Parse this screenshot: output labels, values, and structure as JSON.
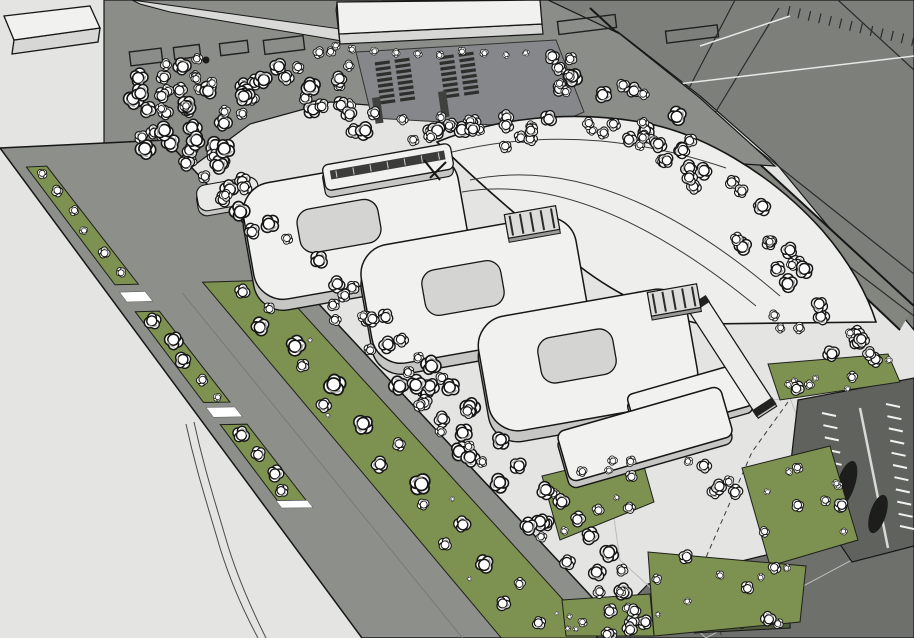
{
  "meta": {
    "app": "3d-architectural-site-model",
    "description": "Aerial oblique rendering of a campus: three rounded courtyard buildings, a large fan-shaped hall, tree-lined boulevard, parking lots and groves of white model trees",
    "canvas": {
      "width": 914,
      "height": 638
    }
  },
  "palette": {
    "field": "#e4e4e2",
    "zone": "#7d7f7a",
    "band": "#8b8d88",
    "road": "#8d8f8a",
    "wedge": "#d9d9d7",
    "green": "#7d9150",
    "hedge": "#4e5b3c",
    "parking_dark": "#60625e",
    "bottom_road": "#6e706c",
    "stall_dark": "#2e2e2c",
    "building_top": "#f1f1ef",
    "building_side": "#d7d7d5",
    "building_base": "#c6c6c4",
    "courtyard": "#d4d4d2",
    "slab_end": "#3a3a38",
    "outline": "#161616",
    "white": "#ffffff",
    "line_dark": "#2b2b2b",
    "line_white": "#e8e8e6",
    "shadow": "#a8a8a6",
    "connector": "#dcdcda",
    "dash": "#3a3a3a"
  },
  "scene": {
    "zone_poly": [
      [
        545,
        0
      ],
      [
        914,
        0
      ],
      [
        914,
        330
      ],
      [
        775,
        162
      ],
      [
        700,
        96
      ],
      [
        618,
        32
      ]
    ],
    "boundary_band": [
      [
        590,
        8
      ],
      [
        914,
        306
      ],
      [
        900,
        330
      ],
      [
        574,
        22
      ]
    ],
    "boundary_lines": [
      [
        590,
        8,
        914,
        306
      ],
      [
        574,
        22,
        900,
        330
      ]
    ],
    "zone_dark_lines": [
      [
        735,
        0,
        686,
        94
      ],
      [
        779,
        8,
        712,
        118
      ],
      [
        690,
        96,
        914,
        274
      ],
      [
        660,
        122,
        914,
        316
      ],
      [
        838,
        0,
        914,
        70
      ]
    ],
    "zone_white_lines": [
      [
        644,
        88,
        914,
        56
      ],
      [
        700,
        46,
        790,
        16
      ]
    ],
    "zone_ticks": {
      "x1": 790,
      "y1": 6,
      "x2": 914,
      "y2": 36,
      "n": 12,
      "len": 10
    },
    "band_poly": [
      [
        104,
        0
      ],
      [
        548,
        0
      ],
      [
        620,
        34
      ],
      [
        700,
        98
      ],
      [
        775,
        166
      ],
      [
        712,
        162
      ],
      [
        546,
        128
      ],
      [
        430,
        110
      ],
      [
        330,
        102
      ],
      [
        250,
        124
      ],
      [
        188,
        170
      ],
      [
        104,
        164
      ]
    ],
    "wedge_poly": [
      [
        132,
        0
      ],
      [
        348,
        30
      ],
      [
        348,
        42
      ],
      [
        170,
        12
      ],
      [
        140,
        4
      ]
    ],
    "footprints": [
      [
        130,
        50,
        32,
        14,
        -7
      ],
      [
        174,
        46,
        26,
        12,
        -7
      ],
      [
        220,
        42,
        28,
        12,
        -7
      ],
      [
        264,
        38,
        40,
        14,
        -7
      ],
      [
        558,
        18,
        58,
        13,
        -7
      ],
      [
        666,
        28,
        52,
        12,
        -7
      ]
    ],
    "footprint_dot": [
      206,
      60,
      3.5
    ],
    "boulevard": {
      "L0": [
        0,
        148
      ],
      "L1": [
        362,
        638
      ],
      "R0": [
        166,
        140
      ],
      "R1": [
        630,
        638
      ],
      "green_a": {
        "f0": 0.07,
        "f1": 0.19,
        "segs": [
          [
            0.04,
            0.28
          ],
          [
            0.335,
            0.52
          ],
          [
            0.565,
            0.72
          ]
        ]
      },
      "green_b": {
        "f0": 0.52,
        "f1": 0.88,
        "segs": [
          [
            0.28,
            1.0
          ]
        ]
      },
      "bars": [
        [
          0.295,
          0.315
        ],
        [
          0.53,
          0.55
        ],
        [
          0.72,
          0.735
        ]
      ],
      "lane_line": {
        "f": 0.375,
        "s0": 0.3,
        "s1": 1.0
      },
      "trees_a": [
        [
          0.055,
          0.13,
          6
        ],
        [
          0.09,
          0.14,
          7
        ],
        [
          0.13,
          0.15,
          6
        ],
        [
          0.17,
          0.12,
          5
        ],
        [
          0.215,
          0.14,
          7
        ],
        [
          0.255,
          0.15,
          6
        ],
        [
          0.355,
          0.12,
          10
        ],
        [
          0.395,
          0.15,
          11
        ],
        [
          0.435,
          0.12,
          10
        ],
        [
          0.475,
          0.14,
          7
        ],
        [
          0.51,
          0.15,
          5
        ],
        [
          0.585,
          0.13,
          10
        ],
        [
          0.625,
          0.14,
          9
        ],
        [
          0.665,
          0.15,
          10
        ],
        [
          0.7,
          0.12,
          8
        ]
      ],
      "trees_b": [
        [
          0.3,
          0.68,
          9
        ],
        [
          0.335,
          0.74,
          7
        ],
        [
          0.37,
          0.62,
          11
        ],
        [
          0.41,
          0.71,
          12
        ],
        [
          0.45,
          0.66,
          8
        ],
        [
          0.49,
          0.73,
          13
        ],
        [
          0.53,
          0.6,
          9
        ],
        [
          0.57,
          0.7,
          12
        ],
        [
          0.61,
          0.78,
          8
        ],
        [
          0.65,
          0.62,
          10
        ],
        [
          0.69,
          0.72,
          13
        ],
        [
          0.73,
          0.66,
          7
        ],
        [
          0.77,
          0.75,
          10
        ],
        [
          0.81,
          0.61,
          8
        ],
        [
          0.85,
          0.7,
          11
        ],
        [
          0.89,
          0.77,
          7
        ],
        [
          0.93,
          0.64,
          9
        ],
        [
          0.97,
          0.71,
          8
        ],
        [
          0.4,
          0.8,
          3
        ],
        [
          0.55,
          0.58,
          3
        ],
        [
          0.72,
          0.8,
          3
        ],
        [
          0.88,
          0.59,
          3
        ],
        [
          0.95,
          0.81,
          2.5
        ]
      ]
    },
    "path_lines": [
      "M 186 424 C 196 470 206 500 220 548 C 230 580 244 612 258 638",
      "M 194 422 C 204 468 214 498 228 546 C 238 578 252 610 266 638"
    ],
    "parking_top": {
      "poly": [
        [
          356,
          52
        ],
        [
          556,
          40
        ],
        [
          584,
          112
        ],
        [
          546,
          128
        ],
        [
          372,
          118
        ]
      ],
      "groups": [
        {
          "x": 392,
          "y": 60,
          "rot": -8,
          "rows": 8,
          "bw": 15,
          "bh": 3.2,
          "cgap": 5,
          "rpitch": 5.6
        },
        {
          "x": 456,
          "y": 54,
          "rot": -8,
          "rows": 8,
          "bw": 15,
          "bh": 3.2,
          "cgap": 5,
          "rpitch": 5.6
        }
      ],
      "lanes": [
        [
          372,
          98,
          8,
          26,
          -8
        ],
        [
          438,
          92,
          8,
          26,
          -8
        ]
      ]
    },
    "comb": {
      "x1": 548,
      "y1": 124,
      "x2": 714,
      "y2": 158,
      "n": 11,
      "len": 8
    },
    "bottom_road_poly": [
      [
        596,
        638
      ],
      [
        648,
        584
      ],
      [
        762,
        556
      ],
      [
        914,
        520
      ],
      [
        914,
        638
      ]
    ],
    "plaza_outline": [
      [
        600,
        420
      ],
      [
        790,
        398
      ],
      [
        852,
        560
      ],
      [
        706,
        638
      ],
      [
        620,
        560
      ]
    ],
    "hedge": {
      "cx": 742,
      "cy": 625,
      "w": 96,
      "h": 11,
      "rot": -3,
      "dots": [
        [
          716,
          624
        ],
        [
          742,
          626
        ],
        [
          768,
          623
        ]
      ]
    },
    "parking_se": {
      "poly": [
        [
          798,
          400
        ],
        [
          914,
          378
        ],
        [
          914,
          546
        ],
        [
          852,
          562
        ],
        [
          790,
          470
        ]
      ],
      "ticks": [
        {
          "x1": 836,
          "y1": 416,
          "x2": 850,
          "y2": 538,
          "n": 10,
          "nx": -14,
          "ny": -3
        },
        {
          "x1": 886,
          "y1": 404,
          "x2": 900,
          "y2": 526,
          "n": 10,
          "nx": 14,
          "ny": 3
        }
      ],
      "aisle": [
        860,
        408,
        888,
        548
      ],
      "blobs": [
        [
          846,
          484,
          9,
          24,
          18
        ],
        [
          878,
          514,
          8,
          20,
          18
        ]
      ]
    },
    "dashed_boundary": "M 788 402 L 752 452 L 704 562 L 722 638",
    "greens": [
      {
        "name": "green-island-ne-of-parking",
        "poly": [
          [
            768,
            364
          ],
          [
            888,
            354
          ],
          [
            900,
            382
          ],
          [
            780,
            400
          ]
        ],
        "n": 8,
        "seed": 37
      },
      {
        "name": "green-island-mid",
        "poly": [
          [
            742,
            468
          ],
          [
            830,
            446
          ],
          [
            858,
            540
          ],
          [
            770,
            566
          ]
        ],
        "n": 11,
        "seed": 41
      },
      {
        "name": "green-island-south",
        "poly": [
          [
            648,
            552
          ],
          [
            806,
            566
          ],
          [
            800,
            622
          ],
          [
            654,
            636
          ]
        ],
        "n": 11,
        "seed": 43
      },
      {
        "name": "green-island-sw",
        "poly": [
          [
            542,
            476
          ],
          [
            640,
            452
          ],
          [
            654,
            502
          ],
          [
            560,
            540
          ]
        ],
        "n": 9,
        "seed": 47
      },
      {
        "name": "green-island-bottom",
        "poly": [
          [
            562,
            600
          ],
          [
            650,
            594
          ],
          [
            654,
            636
          ],
          [
            566,
            636
          ]
        ],
        "n": 7,
        "seed": 53
      }
    ],
    "tree_bands": [
      {
        "name": "north-grove-west",
        "poly": [
          [
            120,
            62
          ],
          [
            358,
            48
          ],
          [
            360,
            104
          ],
          [
            252,
            118
          ],
          [
            190,
            164
          ],
          [
            126,
            148
          ]
        ],
        "n": 55,
        "rmin": 6,
        "rmax": 12,
        "seed": 7
      },
      {
        "name": "grove-south-of-parking",
        "poly": [
          [
            332,
            100
          ],
          [
            560,
            116
          ],
          [
            566,
            148
          ],
          [
            430,
            146
          ],
          [
            336,
            130
          ]
        ],
        "n": 26,
        "rmin": 6,
        "rmax": 11,
        "seed": 11
      },
      {
        "name": "north-grove-east",
        "poly": [
          [
            554,
            46
          ],
          [
            642,
            84
          ],
          [
            702,
            132
          ],
          [
            664,
            166
          ],
          [
            574,
            126
          ],
          [
            546,
            92
          ]
        ],
        "n": 30,
        "rmin": 6,
        "rmax": 12,
        "seed": 13
      },
      {
        "name": "boulevard-verge-upper",
        "poly": [
          [
            178,
            154
          ],
          [
            424,
            416
          ],
          [
            452,
            384
          ],
          [
            206,
            122
          ]
        ],
        "n": 40,
        "rmin": 6,
        "rmax": 12,
        "seed": 17
      },
      {
        "name": "boulevard-verge-lower",
        "poly": [
          [
            424,
            416
          ],
          [
            632,
            638
          ],
          [
            660,
            606
          ],
          [
            452,
            384
          ]
        ],
        "n": 34,
        "rmin": 6,
        "rmax": 12,
        "seed": 19
      },
      {
        "name": "east-boundary-band",
        "poly": [
          [
            696,
            136
          ],
          [
            880,
            326
          ],
          [
            856,
            352
          ],
          [
            746,
            256
          ],
          [
            662,
            158
          ]
        ],
        "n": 24,
        "rmin": 6,
        "rmax": 11,
        "seed": 23
      },
      {
        "name": "east-band-lower",
        "poly": [
          [
            752,
            306
          ],
          [
            886,
            342
          ],
          [
            874,
            370
          ],
          [
            744,
            336
          ]
        ],
        "n": 8,
        "rmin": 5,
        "rmax": 10,
        "seed": 29
      },
      {
        "name": "se-courtyard-cluster",
        "poly": [
          [
            652,
            440
          ],
          [
            748,
            452
          ],
          [
            742,
            502
          ],
          [
            646,
            494
          ]
        ],
        "n": 6,
        "rmin": 5,
        "rmax": 10,
        "seed": 31
      }
    ],
    "tree_row": [
      [
        336,
        46,
        5
      ],
      [
        352,
        49,
        5
      ],
      [
        374,
        51,
        5
      ],
      [
        396,
        53,
        5
      ],
      [
        418,
        54,
        5
      ],
      [
        440,
        55,
        5
      ],
      [
        462,
        51,
        5
      ],
      [
        484,
        53,
        5
      ],
      [
        506,
        55,
        4
      ],
      [
        526,
        53,
        4
      ]
    ],
    "buildings": {
      "slab_nw": {
        "top": [
          [
            4,
            16
          ],
          [
            90,
            6
          ],
          [
            100,
            28
          ],
          [
            14,
            40
          ]
        ],
        "front": [
          [
            14,
            40
          ],
          [
            100,
            28
          ],
          [
            98,
            42
          ],
          [
            12,
            54
          ]
        ]
      },
      "slab_top": {
        "top": [
          [
            337,
            2
          ],
          [
            540,
            0
          ],
          [
            542,
            24
          ],
          [
            339,
            34
          ]
        ],
        "front": [
          [
            339,
            34
          ],
          [
            542,
            24
          ],
          [
            543,
            34
          ],
          [
            340,
            44
          ]
        ],
        "end": [
          [
            337,
            2
          ],
          [
            339,
            34
          ],
          [
            340,
            44
          ],
          [
            336,
            10
          ]
        ]
      },
      "fan": {
        "outer": "M 437 142 Q 490 195 560 250 C 600 286 648 312 700 324 L 876 322 C 868 296 850 262 822 230 C 770 172 700 132 640 122 C 570 110 495 118 437 142 Z",
        "arcs": [
          "M 470 180 Q 610 150 780 296",
          "M 462 192 Q 590 170 756 306",
          "M 452 152 Q 585 120 726 168"
        ]
      },
      "blocks": [
        {
          "name": "courtyard-building-1",
          "cx": 356,
          "cy": 227,
          "w": 218,
          "h": 118,
          "r": 30,
          "rot": -10,
          "dy": 11,
          "court": {
            "cx": 339,
            "cy": 226,
            "w": 82,
            "h": 44,
            "r": 14
          }
        },
        {
          "name": "courtyard-building-2",
          "cx": 474,
          "cy": 290,
          "w": 218,
          "h": 120,
          "r": 30,
          "rot": -10,
          "dy": 11,
          "court": {
            "cx": 463,
            "cy": 288,
            "w": 80,
            "h": 46,
            "r": 14
          }
        },
        {
          "name": "courtyard-building-3",
          "cx": 588,
          "cy": 360,
          "w": 212,
          "h": 116,
          "r": 30,
          "rot": -10,
          "dy": 11,
          "court": {
            "cx": 577,
            "cy": 356,
            "w": 76,
            "h": 46,
            "r": 14
          }
        },
        {
          "name": "low-wing-rear",
          "cx": 690,
          "cy": 400,
          "w": 120,
          "h": 44,
          "r": 6,
          "rot": -16,
          "dy": 7
        },
        {
          "name": "low-wing-front",
          "cx": 645,
          "cy": 434,
          "w": 170,
          "h": 52,
          "r": 8,
          "rot": -16,
          "dy": 7
        }
      ],
      "bar": {
        "cx": 388,
        "cy": 167,
        "w": 130,
        "h": 26,
        "r": 6,
        "rot": -10,
        "dy": 7,
        "stripe": {
          "cx": 388,
          "cy": 165,
          "w": 116,
          "h": 9
        },
        "ticks": 7
      },
      "podium": {
        "cx": 228,
        "cy": 194,
        "w": 62,
        "h": 26,
        "r": 9,
        "rot": -10,
        "dy": 5
      },
      "wing": {
        "cx": 731,
        "cy": 356,
        "w": 22,
        "h": 126,
        "rot": -33,
        "dy": 4,
        "cap_h": 8
      },
      "connectors": [
        {
          "cx": 532,
          "cy": 222,
          "w": 52,
          "h": 24,
          "rot": -10,
          "rungs": 5
        },
        {
          "cx": 674,
          "cy": 300,
          "w": 50,
          "h": 24,
          "rot": -10,
          "rungs": 5
        }
      ],
      "arrow_marks": [
        "M 424 160 L 440 180",
        "M 430 178 L 446 162"
      ]
    }
  }
}
